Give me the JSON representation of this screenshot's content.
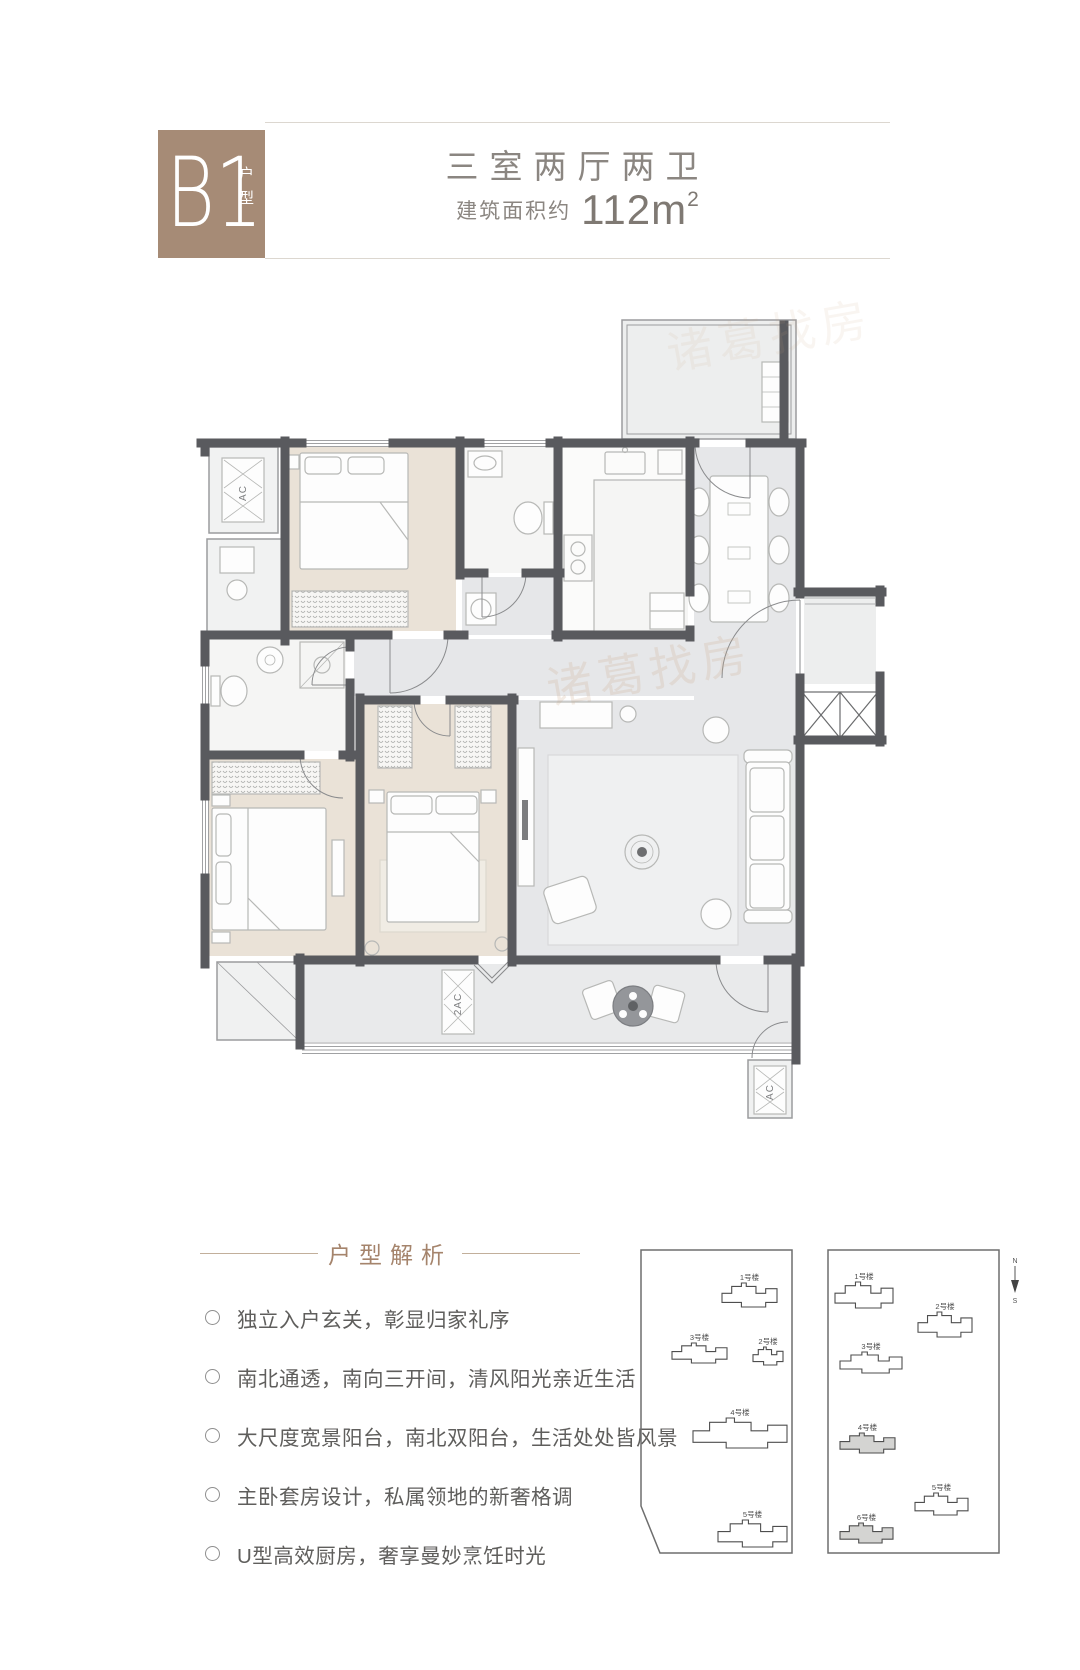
{
  "header": {
    "badge_code": "B1",
    "badge_suffix": "户型",
    "title": "三室两厅两卫",
    "area_label": "建筑面积约",
    "area_value": "112m",
    "area_sup": "2"
  },
  "floorplan": {
    "ac_top": "AC",
    "ac_balcony": "2AC",
    "ac_right": "AC",
    "watermark": "诸葛找房"
  },
  "analysis": {
    "heading": "户型解析",
    "bullets": [
      "独立入户玄关，彰显归家礼序",
      "南北通透，南向三开间，清风阳光亲近生活",
      "大尺度宽景阳台，南北双阳台，生活处处皆风景",
      "主卧套房设计，私属领地的新奢格调",
      "U型高效厨房，奢享曼妙烹饪时光"
    ]
  },
  "siteplans": {
    "compass": {
      "north": "N",
      "south": "S"
    },
    "left": {
      "buildings": [
        {
          "label": "1号楼",
          "x": 92,
          "y": 43,
          "w": 55,
          "h": 24,
          "hl": false
        },
        {
          "label": "3号楼",
          "x": 42,
          "y": 103,
          "w": 55,
          "h": 20,
          "hl": false
        },
        {
          "label": "2号楼",
          "x": 123,
          "y": 107,
          "w": 30,
          "h": 18,
          "hl": false
        },
        {
          "label": "4号楼",
          "x": 63,
          "y": 178,
          "w": 94,
          "h": 30,
          "hl": false
        },
        {
          "label": "5号楼",
          "x": 88,
          "y": 280,
          "w": 69,
          "h": 27,
          "hl": false
        }
      ]
    },
    "right": {
      "buildings": [
        {
          "label": "1号楼",
          "x": 205,
          "y": 42,
          "w": 58,
          "h": 26,
          "hl": false
        },
        {
          "label": "2号楼",
          "x": 288,
          "y": 72,
          "w": 54,
          "h": 25,
          "hl": false
        },
        {
          "label": "3号楼",
          "x": 210,
          "y": 112,
          "w": 62,
          "h": 21,
          "hl": false
        },
        {
          "label": "4号楼",
          "x": 210,
          "y": 193,
          "w": 55,
          "h": 20,
          "hl": true
        },
        {
          "label": "5号楼",
          "x": 285,
          "y": 253,
          "w": 53,
          "h": 22,
          "hl": false
        },
        {
          "label": "6号楼",
          "x": 210,
          "y": 283,
          "w": 53,
          "h": 20,
          "hl": true
        }
      ]
    }
  },
  "colors": {
    "badge": "#a68b76",
    "accent_text": "#a5846c",
    "title_text": "#8b8681",
    "body_text": "#5f5e5c",
    "wall": "#595a5e",
    "floor_bedroom": "#eae2d7",
    "floor_living": "#e6e7e9"
  }
}
